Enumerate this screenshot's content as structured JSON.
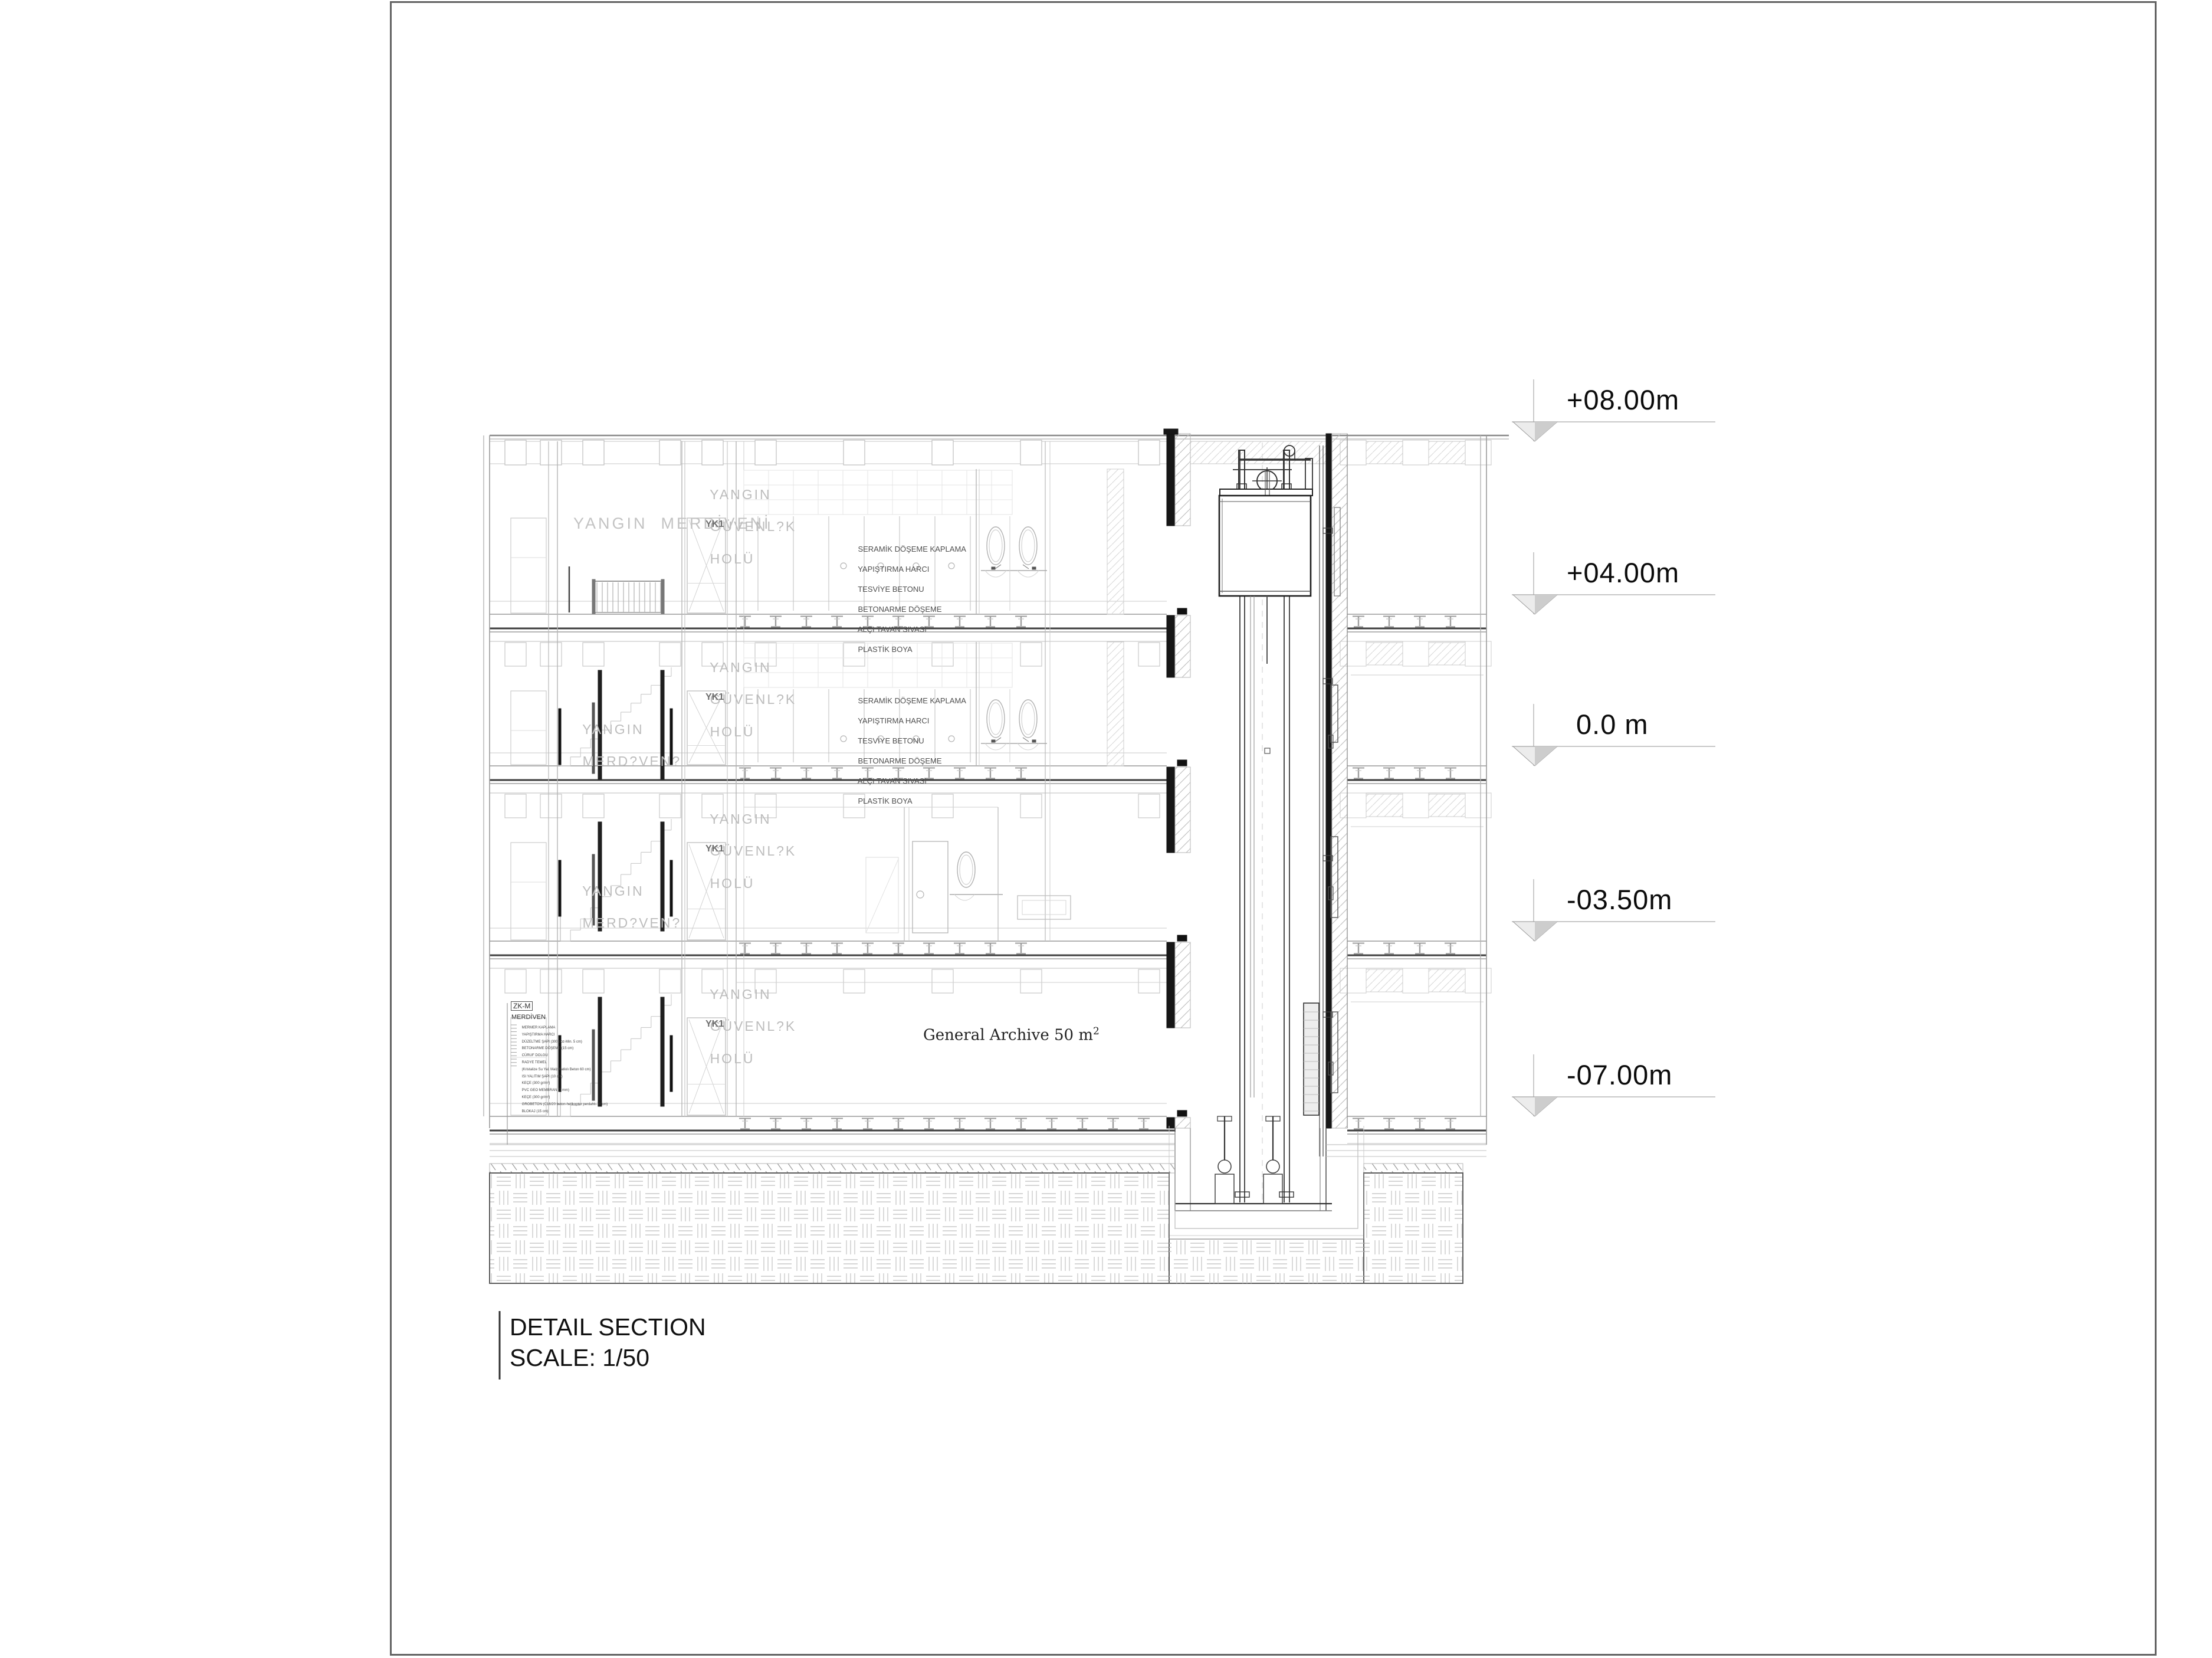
{
  "title_block": {
    "line1": "DETAIL SECTION",
    "line2": "SCALE: 1/50"
  },
  "elevation_markers": [
    {
      "label": "+08.00m"
    },
    {
      "label": "+04.00m"
    },
    {
      "label": "0.0 m"
    },
    {
      "label": "-03.50m"
    },
    {
      "label": "-07.00m"
    }
  ],
  "labels": {
    "fire_stair_top": "YANGIN  MERDİVENİ",
    "fire_stair_lower_line1": "YANGIN",
    "fire_stair_lower_line2": "MERD?VEN?",
    "fire_lobby_line1": "YANGIN",
    "fire_lobby_line2": "GÜVENL?K",
    "fire_lobby_line3": "HOLÜ",
    "door_tag": "YK1",
    "archive_text": "General Archive 50 m",
    "archive_sup": "2"
  },
  "floor_finish_spec": [
    "SERAMİK DÖŞEME KAPLAMA",
    "YAPIŞTIRMA HARCI",
    "TESVİYE BETONU",
    "BETONARME DÖŞEME",
    "ALÇI TAVAN SIVASI",
    "PLASTİK BOYA"
  ],
  "foundation_spec": {
    "code": "ZK-M",
    "title": "MERDİVEN",
    "items": [
      "MERMER KAPLAMA",
      "YAPIŞTIRMA HARCI",
      "DÜZELTME ŞAPI (300 doz-Min. 5 cm)",
      "BETONARME DÖŞEME (15 cm)",
      "CÜRUF DOLGU",
      "RADYE TEMEL",
      "(Kristalize Su Yal. Malz.Katkılı Beton 60 cm)",
      "ISI YALITIM ŞAPI (10 cm)",
      "KEÇE (300 gr/m²)",
      "PVC GEO MEMBRAN (2 mm)",
      "KEÇE (300 gr/m²)",
      "GROBETON (C16/20 beton-helikopter perdahlı-10 cm)",
      "BLOKAJ (15 cm)"
    ]
  }
}
